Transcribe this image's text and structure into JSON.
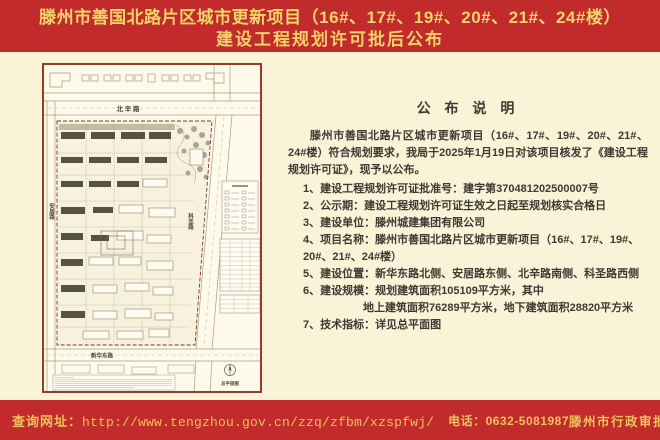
{
  "title": {
    "line1": "滕州市善国北路片区城市更新项目（16#、17#、19#、20#、21#、24#楼）",
    "line2": "建设工程规划许可批后公布"
  },
  "announcement": {
    "heading": "公 布 说 明",
    "intro": "滕州市善国北路片区城市更新项目（16#、17#、19#、20#、21#、24#楼）符合规划要求，我局于2025年1月19日对该项目核发了《建设工程规划许可证》，现予以公布。",
    "items": [
      "1、建设工程规划许可证批准号：建字第370481202500007号",
      "2、公示期：建设工程规划许可证生效之日起至规划核实合格日",
      "3、建设单位：滕州城建集团有限公司",
      "4、项目名称：滕州市善国北路片区城市更新项目（16#、17#、19#、20#、21#、24#楼）",
      "5、建设位置：新华东路北侧、安居路东侧、北辛路南侧、科圣路西侧",
      "6、建设规模：规划建筑面积105109平方米，其中",
      "地上建筑面积76289平方米，地下建筑面积28820平方米",
      "7、技术指标：详见总平面图"
    ]
  },
  "map": {
    "road_top": "北 辛 路",
    "road_bottom": "新华东路",
    "road_left": "安居路",
    "road_right": "科圣路",
    "plan_caption": "总平面图"
  },
  "footer": {
    "url_label": "查询网址：",
    "url": "http://www.tengzhou.gov.cn/zzq/zfbm/xzspfwj/",
    "phone": "电话：0632-5081987",
    "issuer": "滕州市行政审批服务局监制"
  },
  "colors": {
    "background_red": "#c12b2b",
    "title_gold": "#f3d36a",
    "footer_gold": "#eec25c",
    "panel_cream": "#faf3d7",
    "map_frame": "#943c2a"
  }
}
